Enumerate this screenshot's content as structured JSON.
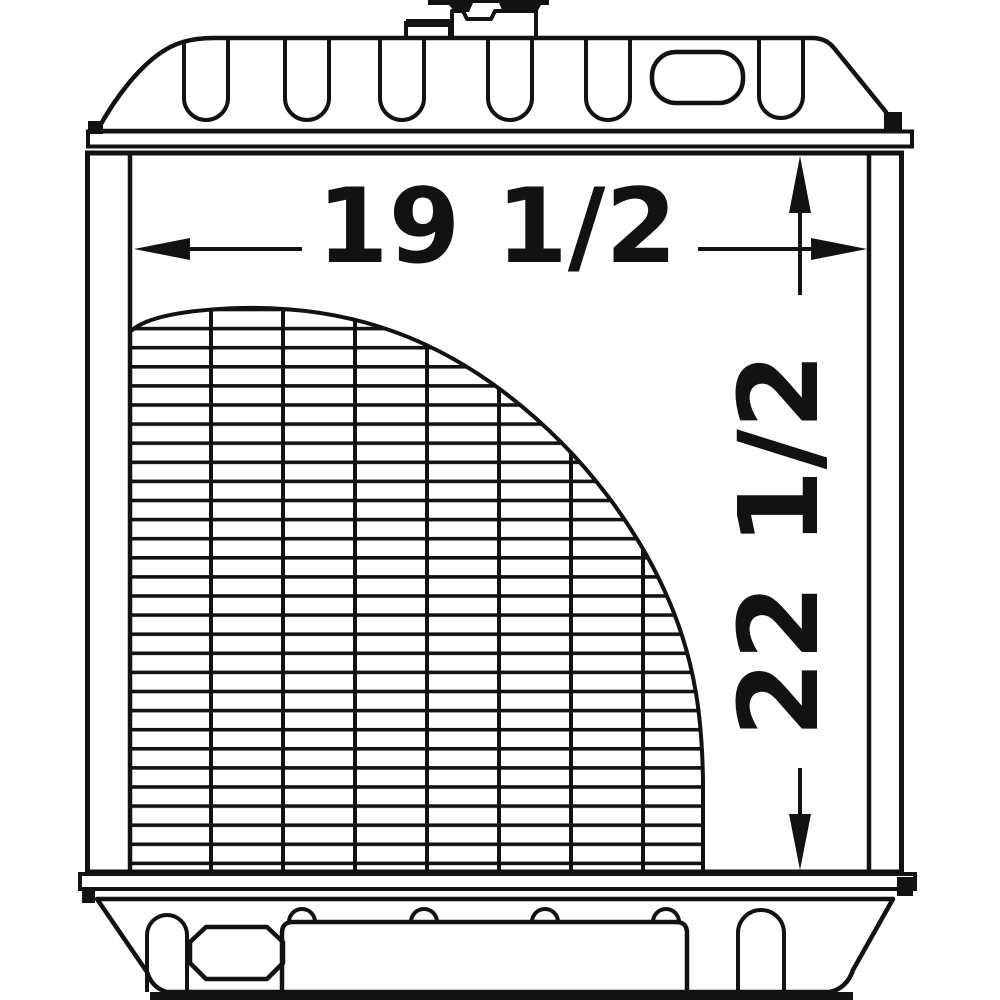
{
  "drawing": {
    "type": "technical-line-drawing",
    "subject": "radiator front view with core fins, top tank, bottom tank and filler cap",
    "dimensions": {
      "width": {
        "label": "19 1/2"
      },
      "height": {
        "label": "22 1/2"
      }
    },
    "colors": {
      "line": "#121212",
      "background": "#ffffff"
    }
  }
}
